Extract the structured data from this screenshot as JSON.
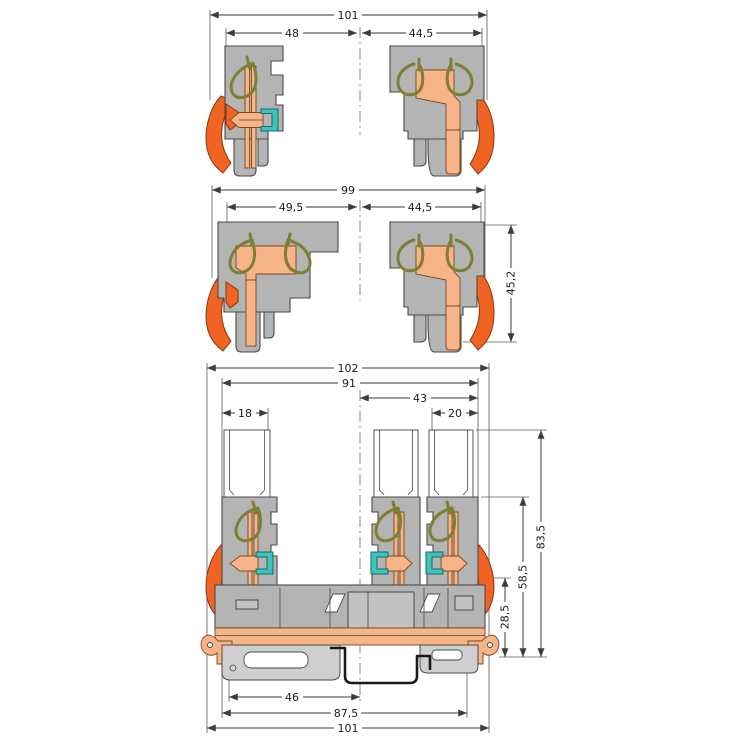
{
  "drawing": {
    "kind": "terminal-block-dimension-drawing",
    "units_note": "",
    "colors": {
      "housing_gray": "#b4b4b4",
      "outline": "#4a4a4a",
      "clamp_spring_olive": "#7f7f33",
      "conductor_copper": "#f6b487",
      "lever_orange": "#f06423",
      "connector_teal": "#3fc3bc",
      "dimension_line": "#3c3c3c"
    }
  },
  "views": {
    "top": {
      "dims": {
        "overall_width": "101",
        "left_width": "48",
        "right_width": "44,5"
      }
    },
    "middle": {
      "dims": {
        "overall_width": "99",
        "left_width": "49,5",
        "right_width": "44,5",
        "height": "45,2"
      }
    },
    "bottom": {
      "dims": {
        "overall_width_top": "102",
        "housing_width": "91",
        "right_half_width": "43",
        "left_pin_width": "18",
        "right_pin_width": "20",
        "total_height": "83,5",
        "upper_height": "58,5",
        "base_height": "28,5",
        "rail_center_offset": "46",
        "rail_width": "87,5",
        "overall_width_bottom": "101"
      }
    }
  }
}
